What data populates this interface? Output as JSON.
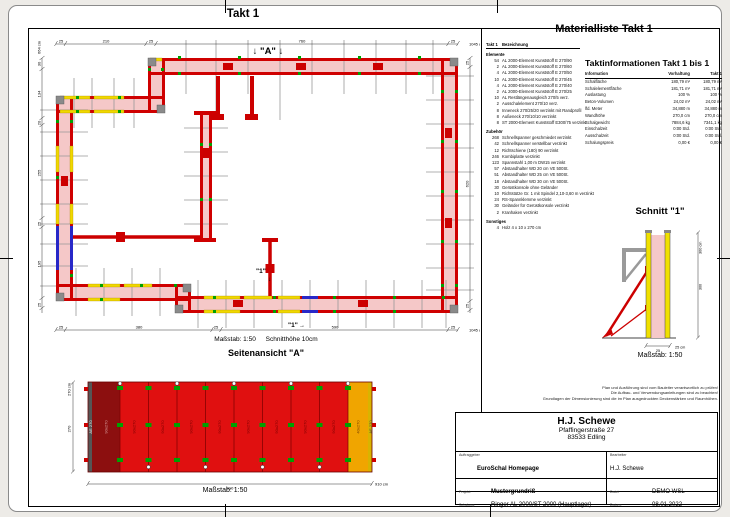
{
  "sheet": {
    "takt_title": "Takt 1"
  },
  "plan": {
    "marker_a": "↓ \"A\" ↓",
    "section_marker_top": "\"1\"",
    "section_marker_bottom": "\"1\"",
    "arrow_down": "↓",
    "arrow_right": "→",
    "scale_label": "Maßstab: 1:50",
    "cut_height_label": "Schnitthöhe 10cm",
    "dims": {
      "top": [
        "25",
        "210",
        "25",
        "760",
        "25"
      ],
      "top_total": "1045 cm",
      "left": [
        "30",
        "134",
        "20",
        "255",
        "25",
        "195",
        "25"
      ],
      "left_total": "664 cm",
      "right": [
        "25",
        "620",
        "25"
      ],
      "bottom": [
        "25",
        "380",
        "25",
        "590",
        "25"
      ],
      "bottom_total": "1045 cm"
    }
  },
  "side": {
    "title": "Seitenansicht \"A\"",
    "dim_left_total": "270 cm",
    "dim_left": "270",
    "dim_bottom": "910",
    "dim_bottom_total": "910 cm",
    "scale_label": "Maßstab: 1:50",
    "panels": [
      "AE 270",
      "90x270",
      "90x270",
      "90x270",
      "90x270",
      "90x270",
      "90x270",
      "90x270",
      "90x270",
      "90x270",
      "40x270",
      "AE 270"
    ]
  },
  "schnitt": {
    "title": "Schnitt \"1\"",
    "dim_right_total": "300 cm",
    "dim_right": "300",
    "dim_width": "25",
    "dim_width_unit": "25 cm",
    "scale_label": "Maßstab: 1:50"
  },
  "materialliste": {
    "title": "Materialliste  Takt 1",
    "header_qty": "Takt 1",
    "header_name": "Bezeichnung",
    "sec_elemente_label": "Elemente",
    "sec_elemente": [
      {
        "q": "54",
        "n": "AL 2000-Element Kunststoff E 270/90"
      },
      {
        "q": "2",
        "n": "AL 2000-Element Kunststoff E 270/60"
      },
      {
        "q": "4",
        "n": "AL 2000-Element Kunststoff E 270/50"
      },
      {
        "q": "10",
        "n": "AL 2000-Element Kunststoff E 270/45"
      },
      {
        "q": "4",
        "n": "AL 2000-Element Kunststoff E 270/40"
      },
      {
        "q": "2",
        "n": "AL 2000-Element Kunststoff E 270/25"
      },
      {
        "q": "10",
        "n": "AL Restlängenausgleich 270/5 verz."
      },
      {
        "q": "2",
        "n": "Ausschalelement 270/10 verz."
      },
      {
        "q": "8",
        "n": "Inneneck 270/25/20 verzinkt mit Randprofil"
      },
      {
        "q": "8",
        "n": "Außeneck 270/10/10 verzinkt"
      },
      {
        "q": "8",
        "n": "ST 2000-Element Kunststoff E300/75 verzinkt"
      }
    ],
    "sec_zubehoer_label": "Zubehör",
    "sec_zubehoer": [
      {
        "q": "268",
        "n": "Schnellspanner geschmiedet verzinkt"
      },
      {
        "q": "42",
        "n": "Schnellspanner verstellbar verzinkt"
      },
      {
        "q": "12",
        "n": "Richtschiene (180) 90 verzinkt"
      },
      {
        "q": "246",
        "n": "Kombiplatte verzinkt"
      },
      {
        "q": "123",
        "n": "Spannstahl 1,00 m DW15 verzinkt"
      },
      {
        "q": "57",
        "n": "Abstandhalter WD 20 cm VE 500St."
      },
      {
        "q": "51",
        "n": "Abstandhalter WD 25 cm VE 500St."
      },
      {
        "q": "18",
        "n": "Abstandhalter WD 30 cm VE 500St."
      },
      {
        "q": "30",
        "n": "Gerüstkonsole ohne Geländer"
      },
      {
        "q": "10",
        "n": "Richtstütze Gr. 1 mit Spindel 2,10-3,60 m verzinkt"
      },
      {
        "q": "24",
        "n": "RS-Spannklemme verzinkt"
      },
      {
        "q": "30",
        "n": "Geländer für Gerüstkonsole verzinkt"
      },
      {
        "q": "2",
        "n": "Kranhaken verzinkt"
      }
    ],
    "sec_sonstiges_label": "Sonstiges",
    "sec_sonstiges": [
      {
        "q": "4",
        "n": "Holz 4 x 10 x 270 cm"
      }
    ]
  },
  "taktinfo": {
    "title": "Taktinformationen  Takt 1 bis 1",
    "col_info": "Information",
    "col_vorhaltung": "Vorhaltung",
    "col_takt": "Takt 1",
    "rows": [
      {
        "i": "Schalfläche",
        "v": "180,79 m²",
        "t": "180,79 m²"
      },
      {
        "i": "Schalelementfläche",
        "v": "181,71 m²",
        "t": "181,71 m²"
      },
      {
        "i": "Auslastung",
        "v": "100 %",
        "t": "100 %"
      },
      {
        "i": "Beton-Volumen",
        "v": "24,02 m³",
        "t": "24,02 m³"
      },
      {
        "i": "lfd. Meter",
        "v": "34,880 m",
        "t": "34,880 m"
      },
      {
        "i": "Wandhöhe",
        "v": "270,0 cm",
        "t": "270,0 cm"
      },
      {
        "i": "Schalgewicht",
        "v": "7884,6 kg",
        "t": "7341,1 kg"
      },
      {
        "i": "Einschalzeit",
        "v": "0:00 Std.",
        "t": "0:00 Std."
      },
      {
        "i": "Ausschalzeit",
        "v": "0:00 Std.",
        "t": "0:00 Std."
      },
      {
        "i": "Schalungspreis",
        "v": "0,00 €",
        "t": "0,00 €"
      }
    ]
  },
  "disclaimer": {
    "line1": "Plan und Ausführung sind vom Bauleiter verantwortlich zu prüfen!",
    "line2": "Die Aufbau- und Verwendungsanleitungen sind zu beachten!",
    "line3": "Grundlagen der Dimensionierung sind die im Plan ausgedruckten Deckenstärken und Raumhöhen."
  },
  "titleblock": {
    "company": "H.J. Schewe",
    "street": "Pfaffingerstraße 27",
    "city": "83533 Edling",
    "auftraggeber_label": "Auftraggeber",
    "auftraggeber": "EuroSchal Homepage",
    "bearbeiter_label": "Bearbeiter",
    "bearbeiter": "H.J. Schewe",
    "projekt_label": "Projekt:",
    "projekt": "Mustergrundriß",
    "datei_label": "Datei:",
    "datei": "DEMO WSL",
    "schalung_label": "Schalung:",
    "schalung": "Ringer AL 2000/ST 2000 (Hauptlager)",
    "datum_label": "Datum:",
    "datum": "08.01.2022"
  },
  "colors": {
    "wall_red": "#cf0000",
    "concrete_pink": "#f5c8c8",
    "panel_yellow": "#f0d800",
    "element_blue": "#2828c8",
    "clamp_green": "#00a000",
    "elevation_red": "#e01010",
    "elevation_darkred": "#8c0f0f",
    "elevation_orange": "#f0a500"
  }
}
